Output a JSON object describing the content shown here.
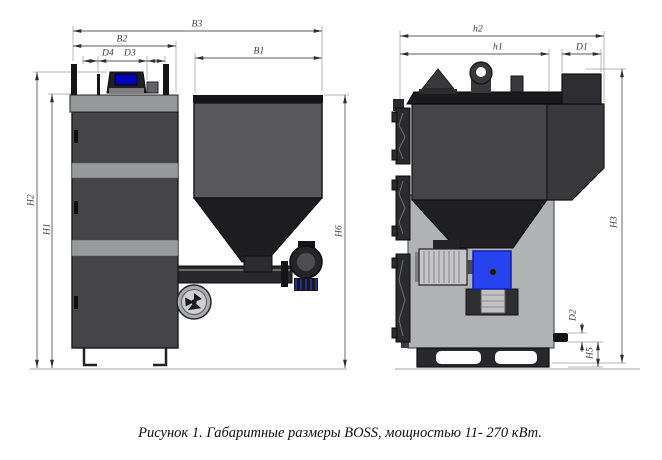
{
  "figure": {
    "caption": "Рисунок 1. Габаритные размеры BOSS, мощностью 11- 270 кВт."
  },
  "views": {
    "front": {
      "title": "front-view-of-boiler-with-hopper",
      "dims": {
        "b3": "B3",
        "b2": "B2",
        "d4": "D4",
        "d3": "D3",
        "b1": "B1",
        "h2": "H2",
        "h1": "H1",
        "h6": "H6"
      }
    },
    "side": {
      "title": "side-view-of-boiler",
      "dims": {
        "h2": "h2",
        "h1": "h1",
        "d1": "D1",
        "h3": "H3",
        "d2": "D2",
        "h5": "H5"
      }
    }
  },
  "colors": {
    "body_dark": "#454548",
    "body_light": "#98999b",
    "hopper_gray": "#59595c",
    "funnel_black": "#1d1d20",
    "panel_blue": "#0006b8",
    "burner_blue": "#2742ef",
    "dim_line": "#5a5b5f"
  }
}
